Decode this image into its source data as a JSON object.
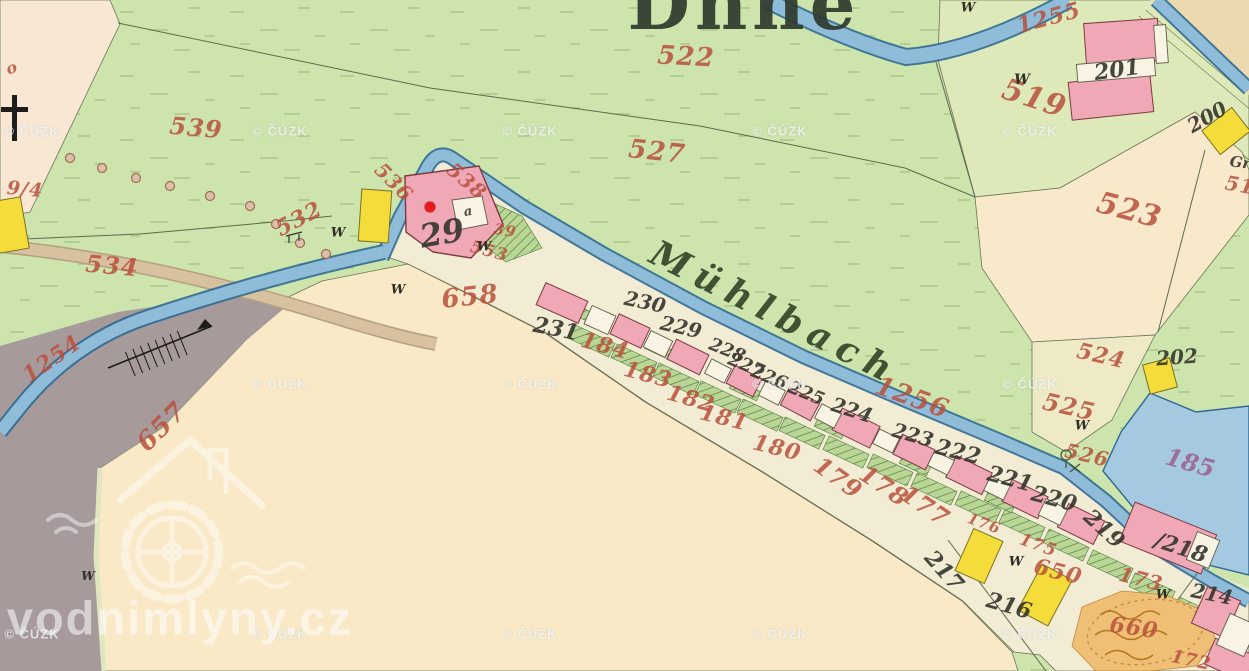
{
  "map": {
    "labels": [
      {
        "type": "title",
        "text": "Dnne",
        "x": 744,
        "y": 4,
        "rot": 0,
        "size": 72,
        "name": "place-name-fragment"
      },
      {
        "type": "stream",
        "text": "Mühlbach",
        "x": 775,
        "y": 313,
        "rot": 27,
        "size": 36,
        "name": "stream-name-label"
      },
      {
        "type": "red",
        "text": "522",
        "x": 686,
        "y": 57,
        "rot": 3,
        "size": 26
      },
      {
        "type": "red",
        "text": "527",
        "x": 657,
        "y": 152,
        "rot": 6,
        "size": 26
      },
      {
        "type": "red",
        "text": "519",
        "x": 1034,
        "y": 99,
        "rot": 18,
        "size": 30
      },
      {
        "type": "red",
        "text": "523",
        "x": 1129,
        "y": 211,
        "rot": 15,
        "size": 30
      },
      {
        "type": "red",
        "text": "1255",
        "x": 1049,
        "y": 18,
        "rot": -15,
        "size": 22
      },
      {
        "type": "red",
        "text": "1254",
        "x": 52,
        "y": 359,
        "rot": -35,
        "size": 22
      },
      {
        "type": "red",
        "text": "1256",
        "x": 912,
        "y": 398,
        "rot": 20,
        "size": 26
      },
      {
        "type": "red",
        "text": "539",
        "x": 196,
        "y": 128,
        "rot": 5,
        "size": 24
      },
      {
        "type": "red",
        "text": "536",
        "x": 394,
        "y": 182,
        "rot": 45,
        "size": 20
      },
      {
        "type": "red",
        "text": "538",
        "x": 467,
        "y": 181,
        "rot": 40,
        "size": 20
      },
      {
        "type": "red",
        "text": "532",
        "x": 299,
        "y": 219,
        "rot": -28,
        "size": 22
      },
      {
        "type": "red",
        "text": "534",
        "x": 112,
        "y": 266,
        "rot": 5,
        "size": 24
      },
      {
        "type": "red",
        "text": "553",
        "x": 489,
        "y": 252,
        "rot": 15,
        "size": 17
      },
      {
        "type": "red",
        "text": "39",
        "x": 505,
        "y": 231,
        "rot": 10,
        "size": 15
      },
      {
        "type": "red",
        "text": "658",
        "x": 470,
        "y": 297,
        "rot": -6,
        "size": 26
      },
      {
        "type": "red",
        "text": "657",
        "x": 162,
        "y": 427,
        "rot": -45,
        "size": 26
      },
      {
        "type": "red",
        "text": "184",
        "x": 605,
        "y": 346,
        "rot": 15,
        "size": 22
      },
      {
        "type": "red",
        "text": "183",
        "x": 648,
        "y": 375,
        "rot": 15,
        "size": 22
      },
      {
        "type": "red",
        "text": "182",
        "x": 691,
        "y": 399,
        "rot": 16,
        "size": 22
      },
      {
        "type": "red",
        "text": "181",
        "x": 724,
        "y": 418,
        "rot": 14,
        "size": 22
      },
      {
        "type": "red",
        "text": "180",
        "x": 777,
        "y": 448,
        "rot": 14,
        "size": 22
      },
      {
        "type": "red",
        "text": "179",
        "x": 838,
        "y": 478,
        "rot": 36,
        "size": 24
      },
      {
        "type": "red",
        "text": "178",
        "x": 884,
        "y": 486,
        "rot": 34,
        "size": 24
      },
      {
        "type": "red",
        "text": "177",
        "x": 925,
        "y": 506,
        "rot": 34,
        "size": 24
      },
      {
        "type": "red",
        "text": "176",
        "x": 984,
        "y": 524,
        "rot": 20,
        "size": 15
      },
      {
        "type": "red",
        "text": "175",
        "x": 1038,
        "y": 546,
        "rot": 20,
        "size": 17
      },
      {
        "type": "red",
        "text": "173",
        "x": 1141,
        "y": 579,
        "rot": 14,
        "size": 20
      },
      {
        "type": "red",
        "text": "172",
        "x": 1191,
        "y": 661,
        "rot": 12,
        "size": 18
      },
      {
        "type": "red",
        "text": "650",
        "x": 1058,
        "y": 572,
        "rot": 14,
        "size": 22
      },
      {
        "type": "red",
        "text": "660",
        "x": 1134,
        "y": 628,
        "rot": 8,
        "size": 22
      },
      {
        "type": "red",
        "text": "525",
        "x": 1069,
        "y": 407,
        "rot": 13,
        "size": 24
      },
      {
        "type": "red",
        "text": "524",
        "x": 1101,
        "y": 356,
        "rot": 13,
        "size": 22
      },
      {
        "type": "red",
        "text": "526",
        "x": 1087,
        "y": 455,
        "rot": 13,
        "size": 20
      },
      {
        "type": "mauve",
        "text": "185",
        "x": 1190,
        "y": 463,
        "rot": 16,
        "size": 24
      },
      {
        "type": "red",
        "text": "51",
        "x": 1240,
        "y": 185,
        "rot": 10,
        "size": 20,
        "name": "parcel-number-fragment-51"
      },
      {
        "type": "red",
        "text": "9/4",
        "x": 25,
        "y": 190,
        "rot": 5,
        "size": 19,
        "name": "parcel-number-fragment-94"
      },
      {
        "type": "red",
        "text": "o",
        "x": 12,
        "y": 68,
        "rot": -20,
        "size": 16,
        "name": "parcel-number-fragment-o"
      },
      {
        "type": "black",
        "text": "201",
        "x": 1117,
        "y": 70,
        "rot": -8,
        "size": 22
      },
      {
        "type": "black",
        "text": "200",
        "x": 1207,
        "y": 117,
        "rot": -30,
        "size": 20
      },
      {
        "type": "black",
        "text": "202",
        "x": 1177,
        "y": 357,
        "rot": -4,
        "size": 20
      },
      {
        "type": "black",
        "text": "29",
        "x": 442,
        "y": 233,
        "rot": -10,
        "size": 32
      },
      {
        "type": "black",
        "text": "a",
        "x": 468,
        "y": 212,
        "rot": -10,
        "size": 13,
        "name": "house-number-fragment-a"
      },
      {
        "type": "black",
        "text": "231",
        "x": 556,
        "y": 329,
        "rot": 11,
        "size": 22
      },
      {
        "type": "black",
        "text": "230",
        "x": 645,
        "y": 302,
        "rot": 12,
        "size": 20
      },
      {
        "type": "black",
        "text": "229",
        "x": 681,
        "y": 327,
        "rot": 13,
        "size": 20
      },
      {
        "type": "black",
        "text": "228",
        "x": 727,
        "y": 351,
        "rot": 22,
        "size": 18
      },
      {
        "type": "black",
        "text": "227",
        "x": 746,
        "y": 366,
        "rot": 22,
        "size": 18
      },
      {
        "type": "black",
        "text": "226",
        "x": 769,
        "y": 378,
        "rot": 22,
        "size": 18
      },
      {
        "type": "black",
        "text": "225",
        "x": 806,
        "y": 394,
        "rot": 22,
        "size": 18
      },
      {
        "type": "black",
        "text": "224",
        "x": 852,
        "y": 410,
        "rot": 18,
        "size": 20
      },
      {
        "type": "black",
        "text": "223",
        "x": 913,
        "y": 435,
        "rot": 16,
        "size": 20
      },
      {
        "type": "black",
        "text": "222",
        "x": 958,
        "y": 452,
        "rot": 14,
        "size": 22
      },
      {
        "type": "black",
        "text": "221",
        "x": 1010,
        "y": 479,
        "rot": 15,
        "size": 22
      },
      {
        "type": "black",
        "text": "220",
        "x": 1054,
        "y": 499,
        "rot": 15,
        "size": 22
      },
      {
        "type": "black",
        "text": "219",
        "x": 1104,
        "y": 529,
        "rot": 42,
        "size": 22
      },
      {
        "type": "black",
        "text": "/218",
        "x": 1181,
        "y": 548,
        "rot": 18,
        "size": 22,
        "name": "house-number-218"
      },
      {
        "type": "black",
        "text": "217",
        "x": 944,
        "y": 571,
        "rot": 48,
        "size": 22
      },
      {
        "type": "black",
        "text": "216",
        "x": 1009,
        "y": 606,
        "rot": 16,
        "size": 22
      },
      {
        "type": "black",
        "text": "214",
        "x": 1212,
        "y": 594,
        "rot": 11,
        "size": 20
      },
      {
        "type": "black",
        "text": "Gr",
        "x": 1240,
        "y": 163,
        "rot": 8,
        "size": 15,
        "name": "text-fragment-gr"
      },
      {
        "type": "w",
        "text": "W",
        "x": 338,
        "y": 233,
        "rot": 0,
        "size": 13,
        "name": "meadow-symbol"
      },
      {
        "type": "w",
        "text": "W",
        "x": 398,
        "y": 290,
        "rot": 0,
        "size": 13,
        "name": "meadow-symbol"
      },
      {
        "type": "w",
        "text": "W",
        "x": 484,
        "y": 247,
        "rot": 0,
        "size": 13,
        "name": "meadow-symbol"
      },
      {
        "type": "w",
        "text": "W",
        "x": 1022,
        "y": 80,
        "rot": 0,
        "size": 14,
        "name": "meadow-symbol"
      },
      {
        "type": "w",
        "text": "W",
        "x": 968,
        "y": 8,
        "rot": 0,
        "size": 13,
        "name": "meadow-symbol"
      },
      {
        "type": "w",
        "text": "W",
        "x": 1082,
        "y": 426,
        "rot": 0,
        "size": 13,
        "name": "meadow-symbol"
      },
      {
        "type": "w",
        "text": "W",
        "x": 1016,
        "y": 562,
        "rot": 0,
        "size": 13,
        "name": "meadow-symbol"
      },
      {
        "type": "w",
        "text": "W",
        "x": 1163,
        "y": 595,
        "rot": 0,
        "size": 13,
        "name": "meadow-symbol"
      },
      {
        "type": "w",
        "text": "W",
        "x": 88,
        "y": 576,
        "rot": 0,
        "size": 12,
        "name": "meadow-symbol"
      }
    ],
    "watermark": {
      "text": "© ČÚZK",
      "positions": [
        [
          32,
          131
        ],
        [
          280,
          131
        ],
        [
          530,
          131
        ],
        [
          780,
          131
        ],
        [
          1030,
          131
        ],
        [
          280,
          384
        ],
        [
          530,
          384
        ],
        [
          780,
          384
        ],
        [
          1030,
          384
        ],
        [
          32,
          634
        ],
        [
          280,
          634
        ],
        [
          530,
          634
        ],
        [
          780,
          634
        ],
        [
          1030,
          634
        ]
      ]
    },
    "brand_watermark": {
      "text": "vodnimlyny.cz",
      "x": 180,
      "y": 618
    },
    "marker": {
      "x": 430,
      "y": 207,
      "color": "#e61b1b"
    },
    "colors": {
      "meadow_green": "#cde4ac",
      "field_cream": "#f9e9c9",
      "band_cream": "#f3ecd4",
      "water_fill": "#8fbcd9",
      "water_edge": "#2f6a94",
      "pond": "#a6c9e2",
      "building_masonry": "#f0a8b6",
      "building_wood": "#f4dd3b",
      "road_tan": "#d8c19e",
      "pasture_gray": "#a79a9a",
      "sandpit": "#eebf75",
      "parcel_number_red": "#b9503c",
      "house_number_black": "#35352c",
      "marker_red": "#e61b1b"
    }
  }
}
